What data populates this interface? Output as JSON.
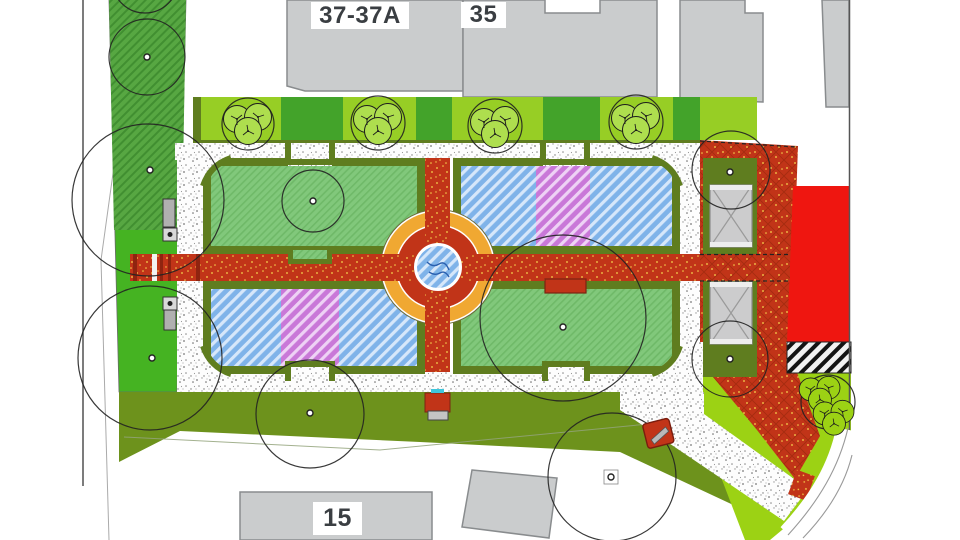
{
  "plan": {
    "buildings": [
      {
        "id": "building-37-37a",
        "label": "37-37A"
      },
      {
        "id": "building-35",
        "label": "35"
      },
      {
        "id": "building-15",
        "label": "15"
      }
    ],
    "colors": {
      "parterre_lawn_green": "#81c87b",
      "parterre_border_olive": "#5f7d1f",
      "olive_lawn": "#6d921c",
      "bright_lawn_green": "#45b322",
      "chartreuse_lawn": "#9cd214",
      "hatched_strip_green": "#57a742",
      "strip_block_light": "#97ce25",
      "strip_block_dark": "#43a32a",
      "flower_bed_blue": "#7fb3e9",
      "flower_bed_purple": "#c978d8",
      "path_brick_red": "#c13418",
      "path_dots_yellow": "#f7d54e",
      "fountain_ring_orange": "#f0a832",
      "fountain_water_blue": "#7fb3e9",
      "building_gray": "#cacccd",
      "building_red": "#ef1610",
      "stipple_walkway": "#fdfdfd",
      "boundary_line": "#555555"
    }
  }
}
